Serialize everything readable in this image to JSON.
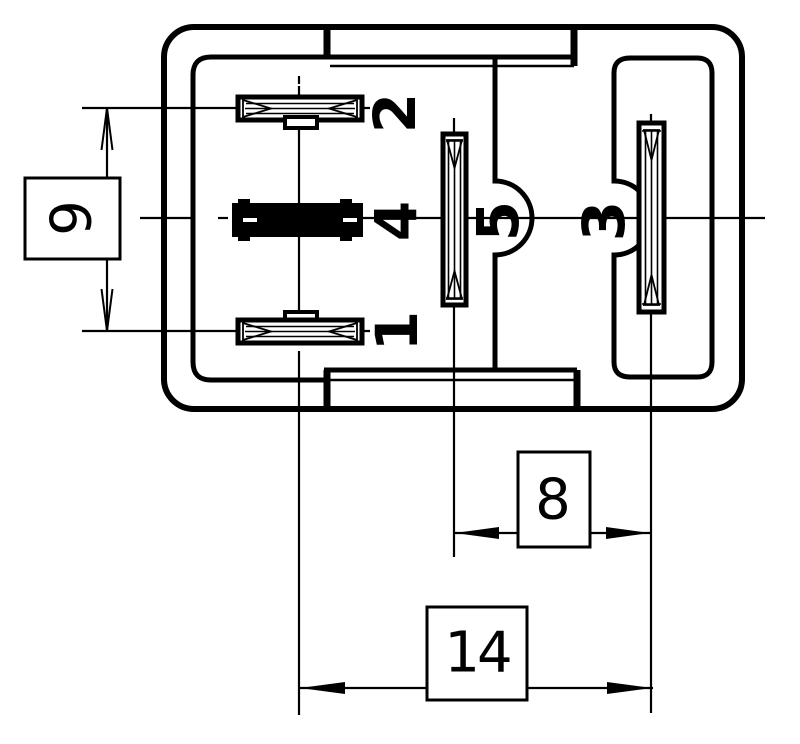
{
  "drawing": {
    "background_color": "#ffffff",
    "line_color": "#000000",
    "pin_labels": {
      "pin1": "1",
      "pin2": "2",
      "pin3": "3",
      "pin4": "4",
      "pin5": "5"
    },
    "dimensions": {
      "vertical_pin_pitch": "9",
      "pitch_pin5_to_pin3": "8",
      "overall_pitch": "14"
    }
  }
}
